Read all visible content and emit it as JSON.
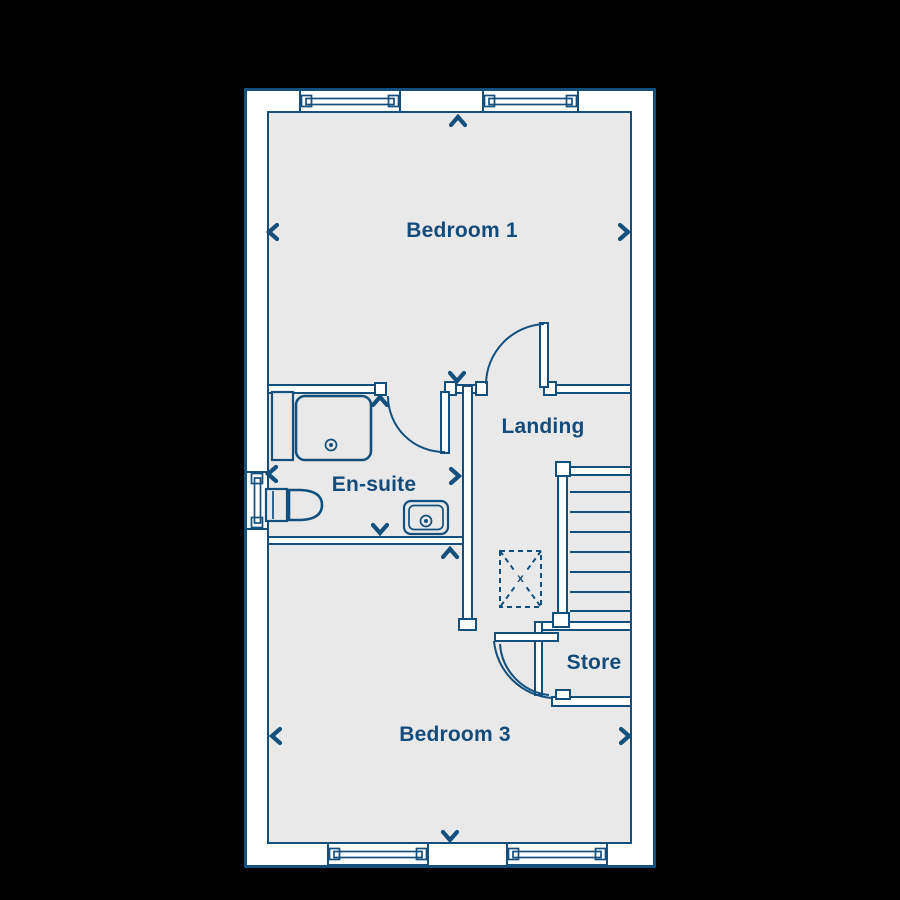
{
  "palette": {
    "background": "#000000",
    "wall_line": "#14507E",
    "floor_fill": "#E9E9E9",
    "wall_fill": "#FFFFFF",
    "label_text": "#134B7B"
  },
  "rooms": [
    {
      "label": "Bedroom 1"
    },
    {
      "label": "Landing"
    },
    {
      "label": "En-suite"
    },
    {
      "label": "Store"
    },
    {
      "label": "Bedroom 3"
    }
  ],
  "symbols": {
    "loft_hatch_glyph": "x",
    "dimension_chevrons": [
      "up",
      "down",
      "left",
      "right"
    ]
  },
  "fixtures": [
    "shower-tray",
    "shower-screen",
    "toilet",
    "wash-basin",
    "staircase",
    "loft-hatch"
  ],
  "windows": {
    "top_wall": 2,
    "bottom_wall": 2,
    "left_wall": 1
  },
  "doors": [
    "bedroom1-to-landing",
    "ensuite-door",
    "landing-to-bedroom3"
  ]
}
